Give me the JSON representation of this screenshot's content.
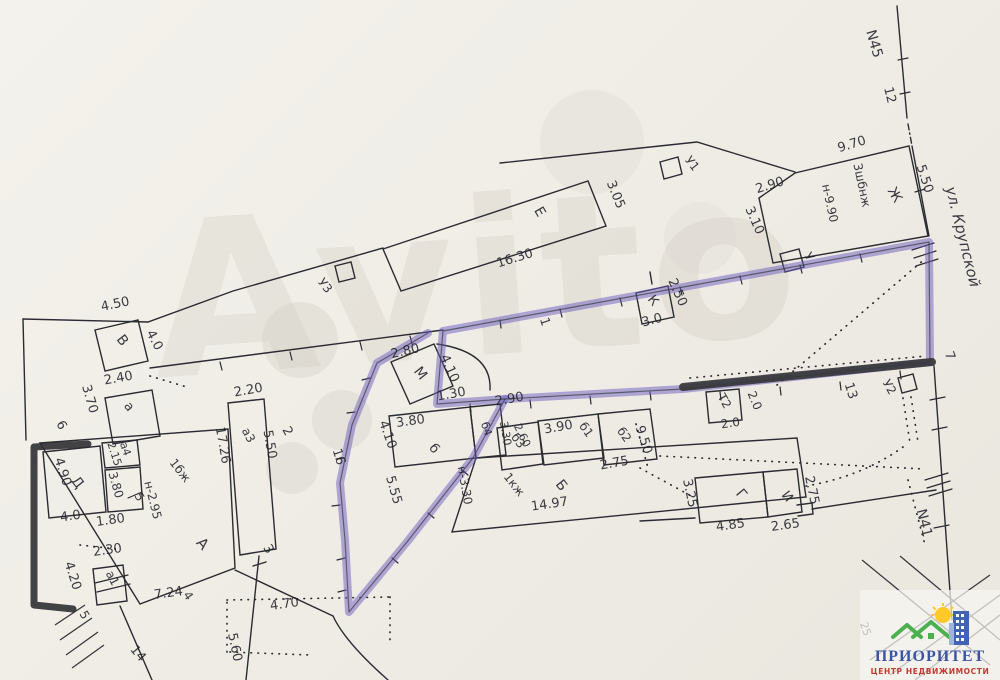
{
  "plan": {
    "street_label": "ул. Крупской",
    "boundary_markers": [
      "N45",
      "N41"
    ],
    "watermark_text": "Avito",
    "labels": [
      {
        "t": "N45",
        "x": 870,
        "y": 45,
        "r": 74,
        "s": 14,
        "n": "label-boundary-n45"
      },
      {
        "t": "12",
        "x": 886,
        "y": 96,
        "r": 76,
        "s": 13,
        "n": "label-point-12"
      },
      {
        "t": "9.70",
        "x": 853,
        "y": 148,
        "r": -17
      },
      {
        "t": "5.50",
        "x": 921,
        "y": 180,
        "r": 72
      },
      {
        "t": "2.90",
        "x": 771,
        "y": 189,
        "r": -17
      },
      {
        "t": "3.10",
        "x": 751,
        "y": 222,
        "r": 66
      },
      {
        "t": "3шбнж",
        "x": 858,
        "y": 186,
        "r": 78,
        "s": 12
      },
      {
        "t": "н-9.90",
        "x": 826,
        "y": 204,
        "r": 78,
        "s": 12
      },
      {
        "t": "Ж",
        "x": 891,
        "y": 197,
        "r": 60,
        "s": 14,
        "n": "label-building-zh"
      },
      {
        "t": "Е",
        "x": 536,
        "y": 214,
        "r": 60,
        "s": 14,
        "n": "label-building-e"
      },
      {
        "t": "3.05",
        "x": 612,
        "y": 196,
        "r": 68
      },
      {
        "t": "16.30",
        "x": 516,
        "y": 262,
        "r": -17
      },
      {
        "t": "У1",
        "x": 689,
        "y": 166,
        "r": 52,
        "s": 12,
        "n": "label-shed-u1"
      },
      {
        "t": "У3",
        "x": 322,
        "y": 288,
        "r": 52,
        "s": 12,
        "n": "label-shed-u3"
      },
      {
        "t": "ул. Крупской",
        "x": 958,
        "y": 238,
        "r": 76,
        "s": 15,
        "i": true,
        "n": "label-street"
      },
      {
        "t": "У",
        "x": 806,
        "y": 259,
        "r": 55,
        "s": 12,
        "n": "label-shed-u"
      },
      {
        "t": "2.50",
        "x": 674,
        "y": 294,
        "r": 66
      },
      {
        "t": "К",
        "x": 650,
        "y": 303,
        "r": 52,
        "s": 13,
        "n": "label-building-k"
      },
      {
        "t": "3.0",
        "x": 653,
        "y": 324,
        "r": -15
      },
      {
        "t": "1",
        "x": 541,
        "y": 323,
        "r": 72,
        "s": 13,
        "n": "label-point-1"
      },
      {
        "t": "7",
        "x": 946,
        "y": 357,
        "r": 70,
        "s": 13,
        "n": "label-point-7"
      },
      {
        "t": "13",
        "x": 847,
        "y": 392,
        "r": 72,
        "s": 13,
        "n": "label-point-13"
      },
      {
        "t": "У2",
        "x": 886,
        "y": 389,
        "r": 60,
        "s": 12,
        "n": "label-shed-u2"
      },
      {
        "t": "Т2",
        "x": 721,
        "y": 403,
        "r": 60,
        "s": 12,
        "n": "label-shed-t2"
      },
      {
        "t": "2.0",
        "x": 751,
        "y": 402,
        "r": 68,
        "s": 12
      },
      {
        "t": "2.0",
        "x": 731,
        "y": 427,
        "r": -8,
        "s": 12
      },
      {
        "t": "2.80",
        "x": 406,
        "y": 355,
        "r": -13
      },
      {
        "t": "М",
        "x": 417,
        "y": 376,
        "r": 52,
        "s": 14,
        "n": "label-building-m"
      },
      {
        "t": "4.10",
        "x": 446,
        "y": 370,
        "r": 66
      },
      {
        "t": "1.30",
        "x": 452,
        "y": 398,
        "r": -10
      },
      {
        "t": "3.80",
        "x": 411,
        "y": 425,
        "r": -8
      },
      {
        "t": "б",
        "x": 431,
        "y": 451,
        "r": 52,
        "s": 13,
        "n": "label-building-b-small"
      },
      {
        "t": "б4",
        "x": 483,
        "y": 430,
        "r": 72,
        "s": 11
      },
      {
        "t": "3.30",
        "x": 502,
        "y": 434,
        "r": 80,
        "s": 11
      },
      {
        "t": "2.60",
        "x": 519,
        "y": 437,
        "r": 64,
        "s": 11
      },
      {
        "t": "2.90",
        "x": 510,
        "y": 403,
        "r": -10
      },
      {
        "t": "б3",
        "x": 515,
        "y": 443,
        "r": 55,
        "s": 12
      },
      {
        "t": "3.90",
        "x": 559,
        "y": 431,
        "r": -10
      },
      {
        "t": "б1",
        "x": 583,
        "y": 432,
        "r": 55,
        "s": 12
      },
      {
        "t": "б2",
        "x": 621,
        "y": 437,
        "r": 55,
        "s": 12
      },
      {
        "t": "9.50",
        "x": 640,
        "y": 441,
        "r": 72
      },
      {
        "t": "2.75",
        "x": 615,
        "y": 467,
        "r": -10
      },
      {
        "t": "н-3.30",
        "x": 461,
        "y": 486,
        "r": 80,
        "s": 12
      },
      {
        "t": "1кж",
        "x": 511,
        "y": 487,
        "r": 52,
        "s": 12
      },
      {
        "t": "Б",
        "x": 558,
        "y": 488,
        "r": 52,
        "s": 14,
        "n": "label-building-b"
      },
      {
        "t": "14.97",
        "x": 550,
        "y": 508,
        "r": -8
      },
      {
        "t": "5.55",
        "x": 390,
        "y": 491,
        "r": 74
      },
      {
        "t": "4.10",
        "x": 384,
        "y": 436,
        "r": 70
      },
      {
        "t": "16",
        "x": 335,
        "y": 458,
        "r": 72,
        "s": 13,
        "n": "label-point-16"
      },
      {
        "t": "Г",
        "x": 738,
        "y": 497,
        "r": 50,
        "s": 14,
        "n": "label-building-g"
      },
      {
        "t": "4.85",
        "x": 731,
        "y": 529,
        "r": -8
      },
      {
        "t": "3.25",
        "x": 686,
        "y": 494,
        "r": 78
      },
      {
        "t": "И",
        "x": 784,
        "y": 499,
        "r": 52,
        "s": 13,
        "n": "label-building-i"
      },
      {
        "t": "2.65",
        "x": 786,
        "y": 529,
        "r": -8
      },
      {
        "t": "2.75",
        "x": 808,
        "y": 491,
        "r": 78
      },
      {
        "t": "N41",
        "x": 920,
        "y": 524,
        "r": 76,
        "s": 14,
        "n": "label-boundary-n41"
      },
      {
        "t": "4.50",
        "x": 116,
        "y": 308,
        "r": -12
      },
      {
        "t": "В",
        "x": 119,
        "y": 343,
        "r": 52,
        "s": 14,
        "n": "label-building-v"
      },
      {
        "t": "4.0",
        "x": 151,
        "y": 342,
        "r": 62
      },
      {
        "t": "2.40",
        "x": 119,
        "y": 382,
        "r": -10
      },
      {
        "t": "3.70",
        "x": 86,
        "y": 400,
        "r": 74
      },
      {
        "t": "6",
        "x": 58,
        "y": 427,
        "r": 62,
        "s": 13,
        "n": "label-point-6"
      },
      {
        "t": "а",
        "x": 126,
        "y": 409,
        "r": 52,
        "s": 13
      },
      {
        "t": "2.20",
        "x": 249,
        "y": 394,
        "r": -10
      },
      {
        "t": "а3",
        "x": 245,
        "y": 437,
        "r": 62,
        "s": 12
      },
      {
        "t": "17.26",
        "x": 219,
        "y": 446,
        "r": 80
      },
      {
        "t": "5.50",
        "x": 266,
        "y": 445,
        "r": 80
      },
      {
        "t": "2",
        "x": 284,
        "y": 433,
        "r": 62,
        "s": 13,
        "n": "label-point-2"
      },
      {
        "t": "а4",
        "x": 122,
        "y": 450,
        "r": 72,
        "s": 11
      },
      {
        "t": "2.15",
        "x": 111,
        "y": 455,
        "r": 72,
        "s": 11
      },
      {
        "t": "Д",
        "x": 74,
        "y": 485,
        "r": 52,
        "s": 14,
        "n": "label-building-d"
      },
      {
        "t": "4.90",
        "x": 59,
        "y": 473,
        "r": 72
      },
      {
        "t": "3.80",
        "x": 112,
        "y": 486,
        "r": 74,
        "s": 12
      },
      {
        "t": "5",
        "x": 136,
        "y": 499,
        "r": 60,
        "s": 12,
        "n": "label-point-5a"
      },
      {
        "t": "1бж",
        "x": 177,
        "y": 473,
        "r": 52,
        "s": 12
      },
      {
        "t": "н-2.95",
        "x": 149,
        "y": 501,
        "r": 76,
        "s": 12
      },
      {
        "t": "4.0",
        "x": 71,
        "y": 520,
        "r": -8
      },
      {
        "t": "1.80",
        "x": 111,
        "y": 524,
        "r": -8
      },
      {
        "t": "2.30",
        "x": 108,
        "y": 554,
        "r": -8
      },
      {
        "t": "а1",
        "x": 109,
        "y": 580,
        "r": 62,
        "s": 12
      },
      {
        "t": "4.20",
        "x": 69,
        "y": 577,
        "r": 72
      },
      {
        "t": "5",
        "x": 81,
        "y": 617,
        "r": 60,
        "s": 12,
        "n": "label-point-5b"
      },
      {
        "t": "А",
        "x": 199,
        "y": 547,
        "r": 48,
        "s": 15,
        "n": "label-building-a"
      },
      {
        "t": "7.24",
        "x": 169,
        "y": 597,
        "r": -8
      },
      {
        "t": "4",
        "x": 185,
        "y": 598,
        "r": 55,
        "s": 12,
        "n": "label-point-4"
      },
      {
        "t": "14",
        "x": 135,
        "y": 656,
        "r": 50,
        "s": 13,
        "n": "label-point-14"
      },
      {
        "t": "3",
        "x": 265,
        "y": 551,
        "r": 60,
        "s": 13,
        "n": "label-point-3"
      },
      {
        "t": "4.70",
        "x": 285,
        "y": 608,
        "r": -8
      },
      {
        "t": "5.60",
        "x": 231,
        "y": 648,
        "r": 78
      },
      {
        "t": "25",
        "x": 862,
        "y": 630,
        "r": 72,
        "s": 11
      }
    ]
  },
  "watermark": {
    "text": "Avito"
  },
  "logo": {
    "title": "ПРИОРИТЕТ",
    "subtitle": "ЦЕНТР НЕДВИЖИМОСТИ",
    "title_color": "#3c55a3",
    "subtitle_color": "#c23a30",
    "roof_color": "#4caf50",
    "sun_color": "#ffc928",
    "building_color": "#3f64b5"
  },
  "highlight": {
    "plot_color": "#6c5cbf",
    "bold_segment_color": "#36363a"
  }
}
